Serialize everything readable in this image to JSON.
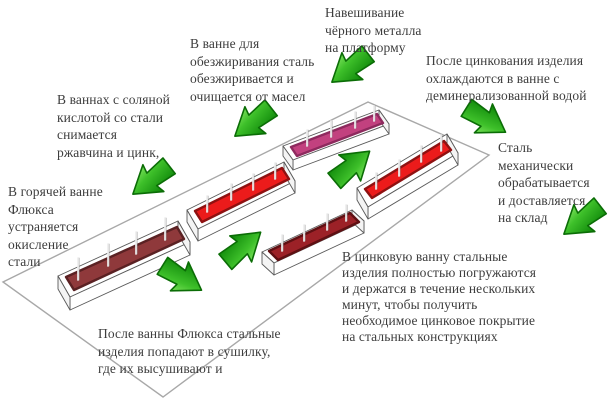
{
  "diagram_subject": "Hot-dip galvanizing process flow (isometric platform with process baths)",
  "colors": {
    "arrow_green_light": "#93ee6e",
    "arrow_green": "#3ec02a",
    "arrow_green_dark": "#128c0c",
    "arrow_outline": "#0b6d06",
    "platform_line": "#a8a8a8",
    "text": "#3d3d3d",
    "pink_liquid": "#c2417f",
    "pink_dark": "#8e2a5e",
    "red_liquid": "#ec1b1b",
    "red_dark": "#8e1111",
    "darkred_liquid": "#9c2127",
    "darkred_dark": "#5f1013",
    "maroon_liquid": "#8f393b",
    "maroon_dark": "#5a2123"
  },
  "labels": {
    "hanging": {
      "lines": [
        "Навешивание",
        "чёрного металла",
        "на платформу"
      ]
    },
    "degreasing": {
      "lines": [
        "В ванне для",
        "обезжиривания сталь",
        "обезжиривается и",
        "очищается от масел"
      ]
    },
    "acid": {
      "lines": [
        "В ваннах с соляной",
        "кислотой со стали",
        "снимается",
        "ржавчина и цинк,"
      ]
    },
    "flux": {
      "lines": [
        "В горячей ванне",
        "Флюкса",
        "устраняется",
        "окисление",
        "стали"
      ]
    },
    "cooling": {
      "lines": [
        "После цинкования изделия",
        "охлаждаются в ванне с",
        "деминерализованной водой"
      ]
    },
    "mechanical": {
      "lines": [
        "Сталь",
        "механически",
        "обрабатывается",
        "и доставляется",
        "на склад"
      ]
    },
    "drying": {
      "lines": [
        "После ванны Флюкса стальные",
        "изделия попадают в сушилку,",
        "где их высушивают и"
      ]
    },
    "zinc": {
      "lines": [
        "В цинковую ванну стальные",
        "изделия полностью погружаются",
        "и держатся в течение нескольких",
        "минут, чтобы получить",
        "необходимое цинковое покрытие",
        "на стальных конструкциях"
      ]
    }
  }
}
